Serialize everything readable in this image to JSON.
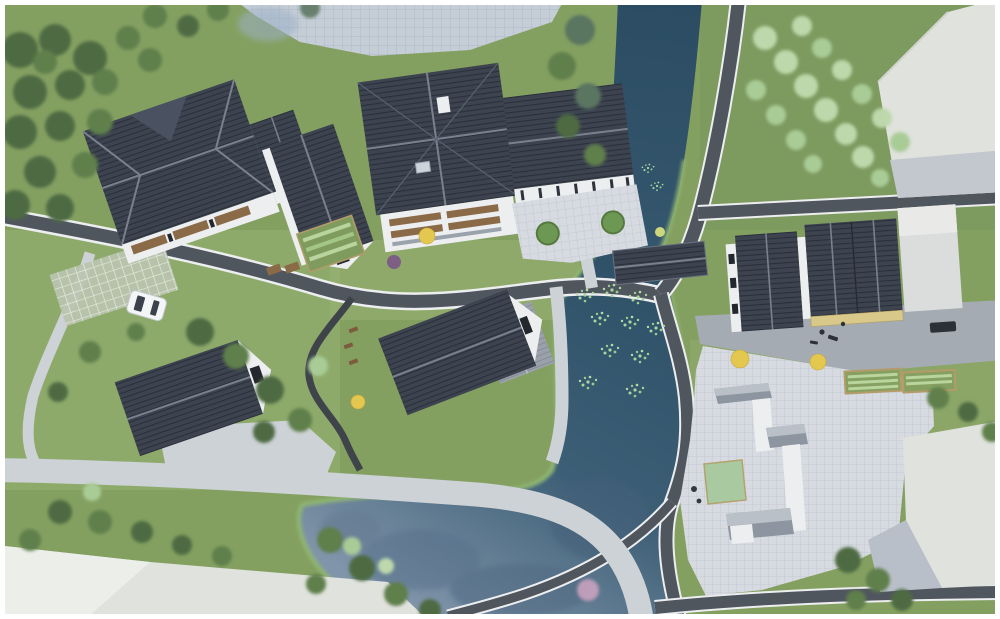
{
  "meta": {
    "title": "aerial-architectural-site-render",
    "view": "top-down bird's-eye 3D rendering",
    "visible_text": "none"
  },
  "colors": {
    "grassBase": "#84a061",
    "grassLight": "#97b274",
    "grassDark": "#6e8a50",
    "grassRight": "#7d9a5f",
    "treeDark": "#4e6b42",
    "treeMid": "#5f7f4c",
    "treeLight": "#a9cc96",
    "treePale": "#bdd9ab",
    "treeYellow": "#e3c74f",
    "treePurple": "#7d5f86",
    "treePink": "#c9a3c0",
    "waterDeep": "#2e5067",
    "waterMid": "#3d5f76",
    "waterPale": "#8195aa",
    "bankGreen": "#8fb573",
    "road": "#50565e",
    "roadLine": "#eceef0",
    "pathLight": "#cdd2d6",
    "plazaBlue": "#c5cdd6",
    "plazaLight": "#d7dbe1",
    "grayPave": "#a4abb2",
    "roofDark": "#3d4450",
    "roofStripe": "#2a303b",
    "roofRidge": "#7a818d",
    "roofLight": "#9aa1ab",
    "wallWhite": "#eceef0",
    "wallShadow": "#c2c6cc",
    "wood": "#8a6a47",
    "yellowWall": "#d8c98a",
    "greenSquare": "#a9c9a1",
    "massWhite": "#e0e2dd",
    "carWhite": "#f3f5f7",
    "frame": "#ffffff"
  },
  "scene": {
    "water_features": [
      {
        "name": "river-channel",
        "position": "top-center flowing south"
      },
      {
        "name": "main-pond",
        "position": "center-bottom",
        "details": "lily-pad clusters, tree reflections"
      }
    ],
    "structures": [
      {
        "name": "large-courtyard-house-northwest",
        "roof": "dark tiled hip roof"
      },
      {
        "name": "small-gable-house-between",
        "roof": "dark tiled gable"
      },
      {
        "name": "main-central-hall",
        "roof": "dark tiled hip with cross ridge, wood balconies"
      },
      {
        "name": "colonnade-pavilion-with-courtyard",
        "details": "paved court, two round topiaries"
      },
      {
        "name": "covered-bridge",
        "position": "over channel"
      },
      {
        "name": "lower-center-house",
        "roof": "dark gable plus light-gray wing"
      },
      {
        "name": "southwest-cottage",
        "roof": "dark gable, white gable end"
      },
      {
        "name": "east-row-houses",
        "details": "two long dark roofs, tan wall"
      },
      {
        "name": "white-massing-block-northeast",
        "style": "untextured context volume"
      },
      {
        "name": "white-massing-block-southeast",
        "style": "untextured context volume"
      },
      {
        "name": "white-massing-block-southwest",
        "style": "untextured context volume"
      },
      {
        "name": "white-wall-courtyard-ruin",
        "position": "south plaza",
        "details": "L-shaped white walls, gray copings, green square lawn"
      }
    ],
    "circulation": [
      {
        "name": "main-asphalt-road",
        "details": "white edge lines, curves west to east"
      },
      {
        "name": "riverside-road",
        "details": "runs along channel and pond"
      },
      {
        "name": "light-stone-footpaths"
      },
      {
        "name": "south-paver-plaza"
      },
      {
        "name": "garden-path-with-benches"
      }
    ],
    "objects": [
      {
        "name": "white-car",
        "position": "parked on grass-paver grid, west"
      },
      {
        "name": "dark-vehicle",
        "position": "east pavement"
      },
      {
        "name": "pedestrians",
        "position": "plaza and pavement"
      },
      {
        "name": "vegetable-beds",
        "position": "center-west and east gardens"
      },
      {
        "name": "yellow-accent-trees",
        "count": 4
      },
      {
        "name": "round-topiaries",
        "count": 2
      }
    ]
  }
}
